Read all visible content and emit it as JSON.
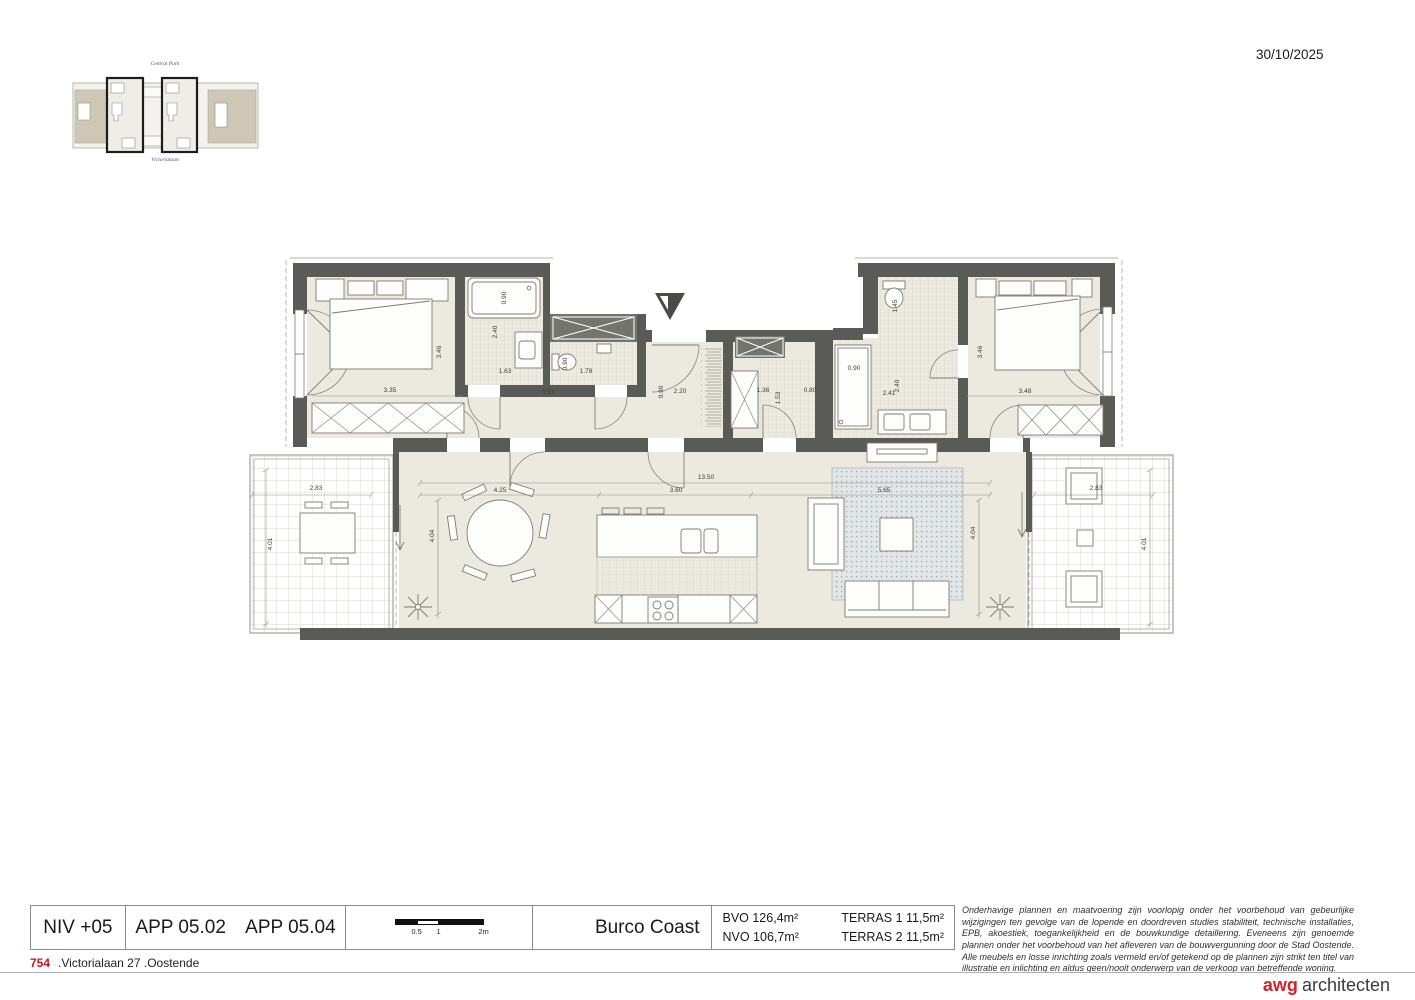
{
  "header": {
    "date": "30/10/2025"
  },
  "site_plan": {
    "top_label": "Central Park",
    "bottom_label": "Victorialaan"
  },
  "title_block": {
    "level": "NIV +05",
    "apartment_1": "APP 05.02",
    "apartment_2": "APP 05.04",
    "scale_ticks": {
      "half": "0.5",
      "one": "1",
      "two": "2m"
    },
    "project": "Burco Coast",
    "areas": {
      "bvo": "BVO 126,4m²",
      "nvo": "NVO 106,7m²",
      "terras1": "TERRAS 1 11,5m²",
      "terras2": "TERRAS 2 11,5m²"
    },
    "disclaimer": "Onderhavige plannen en maatvoering zijn voorlopig onder het voorbehoud van gebeurlijke wijzigingen ten gevolge van de lopende en doordreven studies stabiliteit, technische installaties, EPB, akoestiek, toegankelijkheid en de bouwkundige detaillering. Eveneens zijn genoemde plannen onder het voorbehoud van het afleveren van de bouwvergunning door de Stad Oostende. Alle meubels en losse inrichting zoals vermeld en/of getekend op de plannen zijn strikt ten titel van illustratie en inlichting en aldus geen/nooit onderwerp van de verkoop van betreffende woning."
  },
  "footer": {
    "number": "754",
    "address": ".Victorialaan 27 .Oostende",
    "logo_bold": "awg",
    "logo_rest": "architecten"
  },
  "colors": {
    "wall": "#5a5a57",
    "floor": "#ece9e1",
    "accent_red": "#d2232a"
  },
  "plan": {
    "dimensions": [
      {
        "t": "3.35",
        "x": 390,
        "y": 392
      },
      {
        "t": "3.46",
        "x": 441,
        "y": 352,
        "r": -90
      },
      {
        "t": "0.90",
        "x": 506,
        "y": 298,
        "r": -90
      },
      {
        "t": "2.40",
        "x": 497,
        "y": 332,
        "r": -90
      },
      {
        "t": "1.63",
        "x": 505,
        "y": 373
      },
      {
        "t": "0.90",
        "x": 567,
        "y": 364,
        "r": -90
      },
      {
        "t": "1.78",
        "x": 586,
        "y": 373
      },
      {
        "t": "3.51",
        "x": 548,
        "y": 394
      },
      {
        "t": "0.90",
        "x": 663,
        "y": 392,
        "r": -90
      },
      {
        "t": "2.20",
        "x": 680,
        "y": 393
      },
      {
        "t": "1.36",
        "x": 763,
        "y": 392
      },
      {
        "t": "1.53",
        "x": 780,
        "y": 398,
        "r": -90
      },
      {
        "t": "0.80",
        "x": 810,
        "y": 392
      },
      {
        "t": "0.90",
        "x": 854,
        "y": 370
      },
      {
        "t": "1.45",
        "x": 897,
        "y": 306,
        "r": -90
      },
      {
        "t": "2.41",
        "x": 889,
        "y": 395
      },
      {
        "t": "2.40",
        "x": 899,
        "y": 386,
        "r": -90
      },
      {
        "t": "3.48",
        "x": 1025,
        "y": 393
      },
      {
        "t": "3.46",
        "x": 982,
        "y": 352,
        "r": -90
      },
      {
        "t": "13.50",
        "x": 706,
        "y": 479
      },
      {
        "t": "4.25",
        "x": 500,
        "y": 492
      },
      {
        "t": "3.60",
        "x": 676,
        "y": 492
      },
      {
        "t": "5.65",
        "x": 884,
        "y": 492
      },
      {
        "t": "4.04",
        "x": 434,
        "y": 536,
        "r": -90
      },
      {
        "t": "4.04",
        "x": 975,
        "y": 533,
        "r": -90
      },
      {
        "t": "2.83",
        "x": 316,
        "y": 490
      },
      {
        "t": "4.01",
        "x": 272,
        "y": 544,
        "r": -90
      },
      {
        "t": "2.83",
        "x": 1096,
        "y": 490
      },
      {
        "t": "4.01",
        "x": 1146,
        "y": 544,
        "r": -90
      }
    ]
  }
}
